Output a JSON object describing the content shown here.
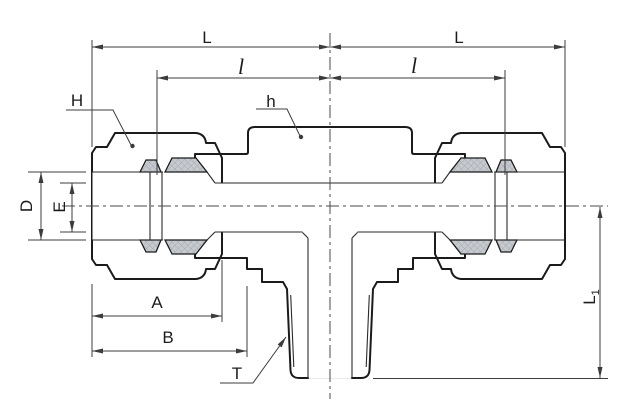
{
  "drawing": {
    "type": "engineering-cross-section",
    "subject": "Compression tube fitting - male branch tee, sectional view with dimensions",
    "background": "#ffffff",
    "colors": {
      "outline": "#1b1b1b",
      "dim_line": "#3c3c3c",
      "body_fill": "#dcdee1",
      "nut_fill": "#d2d5d9",
      "ferrule_fill": "#c6cacf",
      "hatch_line": "#9aa0a7",
      "bore_fill": "#ffffff"
    },
    "labels": {
      "L_left": "L",
      "L_right": "L",
      "l_left": "l",
      "l_right": "l",
      "H": "H",
      "h": "h",
      "D": "D",
      "E": "E",
      "A": "A",
      "B": "B",
      "T": "T",
      "L1_main": "L",
      "L1_sub": "1"
    }
  }
}
